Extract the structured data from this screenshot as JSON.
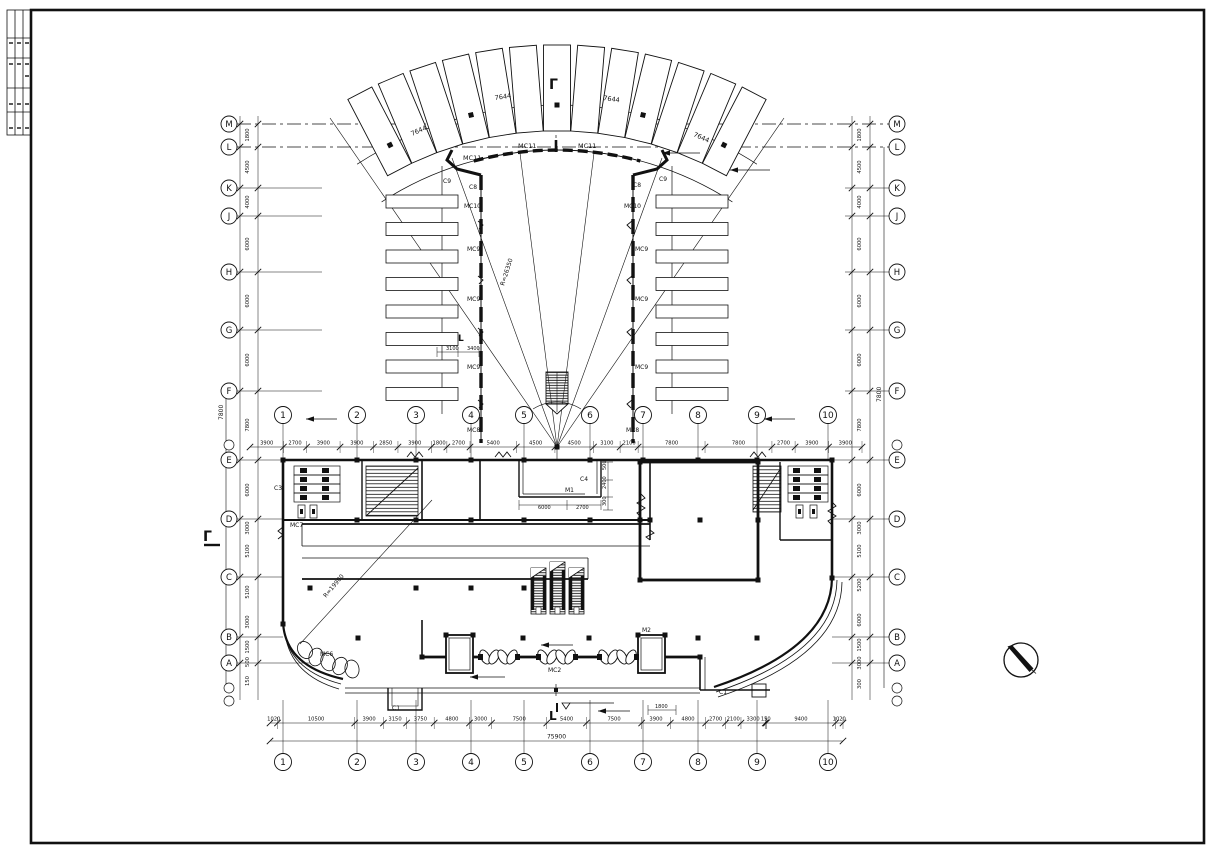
{
  "page": {
    "width": 1213,
    "height": 855,
    "bg": "#ffffff",
    "line_color": "#111111"
  },
  "grid": {
    "left_letters": [
      {
        "t": "M",
        "y": 124
      },
      {
        "t": "L",
        "y": 147
      },
      {
        "t": "K",
        "y": 188
      },
      {
        "t": "J",
        "y": 216
      },
      {
        "t": "H",
        "y": 272
      },
      {
        "t": "G",
        "y": 330
      },
      {
        "t": "F",
        "y": 391
      },
      {
        "t": "E",
        "y": 460
      },
      {
        "t": "D",
        "y": 519
      },
      {
        "t": "C",
        "y": 577
      },
      {
        "t": "B",
        "y": 637
      },
      {
        "t": "A",
        "y": 663
      }
    ],
    "right_letters": [
      {
        "t": "M",
        "y": 124
      },
      {
        "t": "L",
        "y": 147
      },
      {
        "t": "K",
        "y": 188
      },
      {
        "t": "J",
        "y": 216
      },
      {
        "t": "H",
        "y": 272
      },
      {
        "t": "G",
        "y": 330
      },
      {
        "t": "F",
        "y": 391
      },
      {
        "t": "E",
        "y": 460
      },
      {
        "t": "D",
        "y": 519
      },
      {
        "t": "C",
        "y": 577
      },
      {
        "t": "B",
        "y": 637
      },
      {
        "t": "A",
        "y": 663
      }
    ],
    "numbers": [
      {
        "t": "1",
        "x": 283
      },
      {
        "t": "2",
        "x": 357
      },
      {
        "t": "3",
        "x": 416
      },
      {
        "t": "4",
        "x": 471
      },
      {
        "t": "5",
        "x": 524
      },
      {
        "t": "6",
        "x": 590
      },
      {
        "t": "7",
        "x": 643
      },
      {
        "t": "8",
        "x": 698
      },
      {
        "t": "9",
        "x": 757
      },
      {
        "t": "10",
        "x": 828
      }
    ]
  },
  "dims": {
    "bottom": {
      "y": 723,
      "x0": 270,
      "x1": 843,
      "values": [
        "1020",
        "10500",
        "3900",
        "3150",
        "3750",
        "4800",
        "3000",
        "7500",
        "5400",
        "7500",
        "3900",
        "4800",
        "2700",
        "2100",
        "3300",
        "150",
        "9400",
        "1020"
      ],
      "total": "75900",
      "total_y": 741
    },
    "middle": {
      "y": 447,
      "x0": 250,
      "x1": 862,
      "values": [
        "3900",
        "2700",
        "3900",
        "3900",
        "2850",
        "3900",
        "1800",
        "2700",
        "5400",
        "4500",
        "4500",
        "3100",
        "2100",
        "7800",
        "7800",
        "2700",
        "3900",
        "3900"
      ]
    },
    "left_upper": [
      {
        "t": "1800",
        "y": 135
      },
      {
        "t": "4500",
        "y": 167
      },
      {
        "t": "4000",
        "y": 202
      },
      {
        "t": "6000",
        "y": 244
      },
      {
        "t": "6000",
        "y": 301
      },
      {
        "t": "6000",
        "y": 360
      },
      {
        "t": "7800",
        "y": 425
      }
    ],
    "left_lower": [
      {
        "t": "6000",
        "y": 490
      },
      {
        "t": "3000",
        "y": 528
      },
      {
        "t": "5100",
        "y": 551
      },
      {
        "t": "5100",
        "y": 592
      },
      {
        "t": "3000",
        "y": 622
      },
      {
        "t": "1500",
        "y": 647
      },
      {
        "t": "500",
        "y": 662
      },
      {
        "t": "150",
        "y": 681
      }
    ],
    "right_upper": [
      {
        "t": "1800",
        "y": 135
      },
      {
        "t": "4500",
        "y": 167
      },
      {
        "t": "4000",
        "y": 202
      },
      {
        "t": "6000",
        "y": 244
      },
      {
        "t": "6000",
        "y": 301
      },
      {
        "t": "6000",
        "y": 360
      },
      {
        "t": "7800",
        "y": 425
      }
    ],
    "right_lower": [
      {
        "t": "6000",
        "y": 490
      },
      {
        "t": "3000",
        "y": 528
      },
      {
        "t": "5100",
        "y": 551
      },
      {
        "t": "5200",
        "y": 585
      },
      {
        "t": "6000",
        "y": 620
      },
      {
        "t": "1500",
        "y": 645
      },
      {
        "t": "3000",
        "y": 663
      },
      {
        "t": "300",
        "y": 684
      }
    ]
  },
  "labels": [
    {
      "t": "Γ",
      "x": 549,
      "y": 89,
      "fs": 14,
      "b": 1
    },
    {
      "t": "Γ",
      "x": 203,
      "y": 541,
      "fs": 14,
      "b": 1
    },
    {
      "t": "L",
      "x": 549,
      "y": 720,
      "fs": 12,
      "b": 1
    },
    {
      "t": "L",
      "x": 458,
      "y": 341,
      "fs": 9,
      "b": 1
    },
    {
      "t": "7644",
      "x": 495,
      "y": 100,
      "r": -8
    },
    {
      "t": "7644",
      "x": 603,
      "y": 100,
      "r": 8
    },
    {
      "t": "7644",
      "x": 412,
      "y": 136,
      "r": -24
    },
    {
      "t": "7644",
      "x": 693,
      "y": 136,
      "r": 24
    },
    {
      "t": "MC11",
      "x": 463,
      "y": 160
    },
    {
      "t": "MC11",
      "x": 518,
      "y": 148
    },
    {
      "t": "MC11",
      "x": 578,
      "y": 148
    },
    {
      "t": "C9",
      "x": 443,
      "y": 183,
      "fs": 6
    },
    {
      "t": "C8",
      "x": 469,
      "y": 189,
      "fs": 6
    },
    {
      "t": "C9",
      "x": 659,
      "y": 181,
      "fs": 6
    },
    {
      "t": "C8",
      "x": 633,
      "y": 187,
      "fs": 6
    },
    {
      "t": "MC10",
      "x": 464,
      "y": 208,
      "fs": 6
    },
    {
      "t": "MC10",
      "x": 624,
      "y": 208,
      "fs": 6
    },
    {
      "t": "MC9",
      "x": 467,
      "y": 251,
      "fs": 6
    },
    {
      "t": "MC9",
      "x": 467,
      "y": 301,
      "fs": 6
    },
    {
      "t": "MC9",
      "x": 467,
      "y": 369,
      "fs": 6
    },
    {
      "t": "MC9",
      "x": 635,
      "y": 251,
      "fs": 6
    },
    {
      "t": "MC9",
      "x": 635,
      "y": 301,
      "fs": 6
    },
    {
      "t": "MC9",
      "x": 635,
      "y": 369,
      "fs": 6
    },
    {
      "t": "MC8",
      "x": 467,
      "y": 432,
      "fs": 6
    },
    {
      "t": "MC8",
      "x": 626,
      "y": 432,
      "fs": 6
    },
    {
      "t": "R=26350",
      "x": 504,
      "y": 286,
      "r": -72,
      "fs": 6
    },
    {
      "t": "R=19900",
      "x": 326,
      "y": 598,
      "r": -50,
      "fs": 6
    },
    {
      "t": "3100",
      "x": 446,
      "y": 350,
      "fs": 5
    },
    {
      "t": "3400",
      "x": 467,
      "y": 350,
      "fs": 5
    },
    {
      "t": "C3",
      "x": 274,
      "y": 490,
      "fs": 6
    },
    {
      "t": "MC7",
      "x": 290,
      "y": 527,
      "fs": 6
    },
    {
      "t": "MC6",
      "x": 320,
      "y": 656,
      "fs": 6
    },
    {
      "t": "C1",
      "x": 392,
      "y": 710,
      "fs": 6
    },
    {
      "t": "C1",
      "x": 719,
      "y": 694,
      "fs": 6
    },
    {
      "t": "MC2",
      "x": 548,
      "y": 672,
      "fs": 6
    },
    {
      "t": "M2",
      "x": 642,
      "y": 632,
      "fs": 6
    },
    {
      "t": "M1",
      "x": 565,
      "y": 492,
      "fs": 6
    },
    {
      "t": "C4",
      "x": 580,
      "y": 481,
      "fs": 6
    },
    {
      "t": "6000",
      "x": 538,
      "y": 509,
      "fs": 5
    },
    {
      "t": "2700",
      "x": 576,
      "y": 509,
      "fs": 5
    },
    {
      "t": "500",
      "x": 606,
      "y": 470,
      "fs": 5,
      "r": -90
    },
    {
      "t": "2400",
      "x": 606,
      "y": 489,
      "fs": 5,
      "r": -90
    },
    {
      "t": "300",
      "x": 606,
      "y": 506,
      "fs": 5,
      "r": -90
    },
    {
      "t": "1800",
      "x": 655,
      "y": 708,
      "fs": 5
    },
    {
      "t": "7800",
      "x": 881,
      "y": 402,
      "fs": 6,
      "r": -90
    },
    {
      "t": "7800",
      "x": 223,
      "y": 420,
      "fs": 6,
      "r": -90
    }
  ],
  "marks": {
    "north_arrow": {
      "x": 1021,
      "y": 660,
      "r": 17
    }
  }
}
